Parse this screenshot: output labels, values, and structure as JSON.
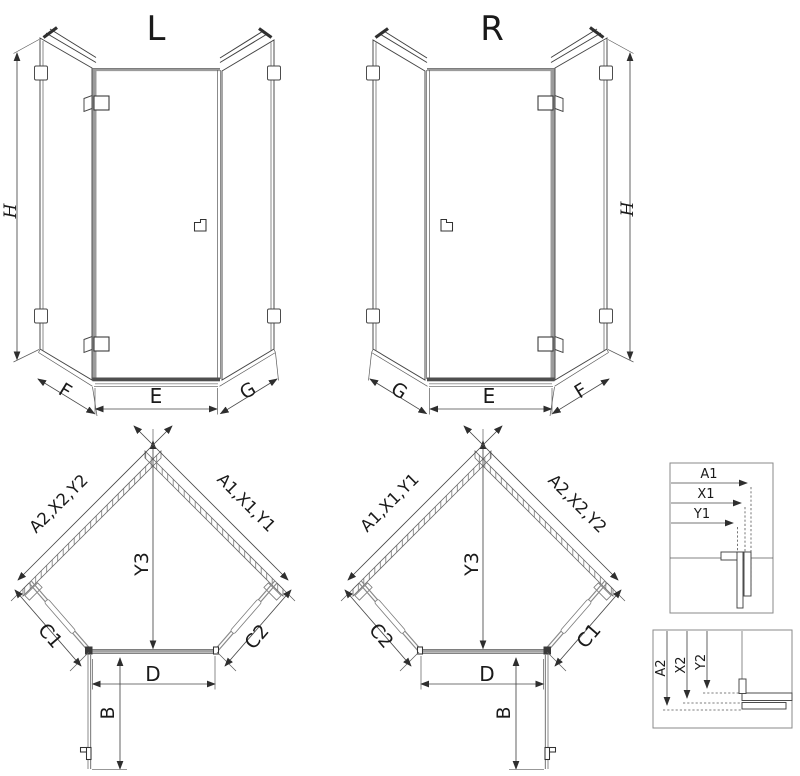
{
  "elevation_left": {
    "title": "L",
    "height_label": "H",
    "left_panel_label": "F",
    "door_label": "E",
    "right_panel_label": "G"
  },
  "elevation_right": {
    "title": "R",
    "height_label": "H",
    "left_panel_label": "G",
    "door_label": "E",
    "right_panel_label": "F"
  },
  "plan_left": {
    "upper_left_wall": "A2,X2,Y2",
    "upper_right_wall": "A1,X1,Y1",
    "apex_depth": "Y3",
    "lower_left_panel": "C1",
    "lower_right_panel": "C2",
    "door_width": "D",
    "door_swing": "B"
  },
  "plan_right": {
    "upper_left_wall": "A1,X1,Y1",
    "upper_right_wall": "A2,X2,Y2",
    "apex_depth": "Y3",
    "lower_left_panel": "C2",
    "lower_right_panel": "C1",
    "door_width": "D",
    "door_swing": "B"
  },
  "detail_top": {
    "labels": [
      "A1",
      "X1",
      "Y1"
    ]
  },
  "detail_bottom": {
    "labels": [
      "A2",
      "X2",
      "Y2"
    ]
  },
  "colors": {
    "line": "#3f3f3f",
    "dimension": "#474747",
    "profile_gray": "#9b9b9b",
    "text": "#1a1a1a",
    "background": "#ffffff"
  }
}
